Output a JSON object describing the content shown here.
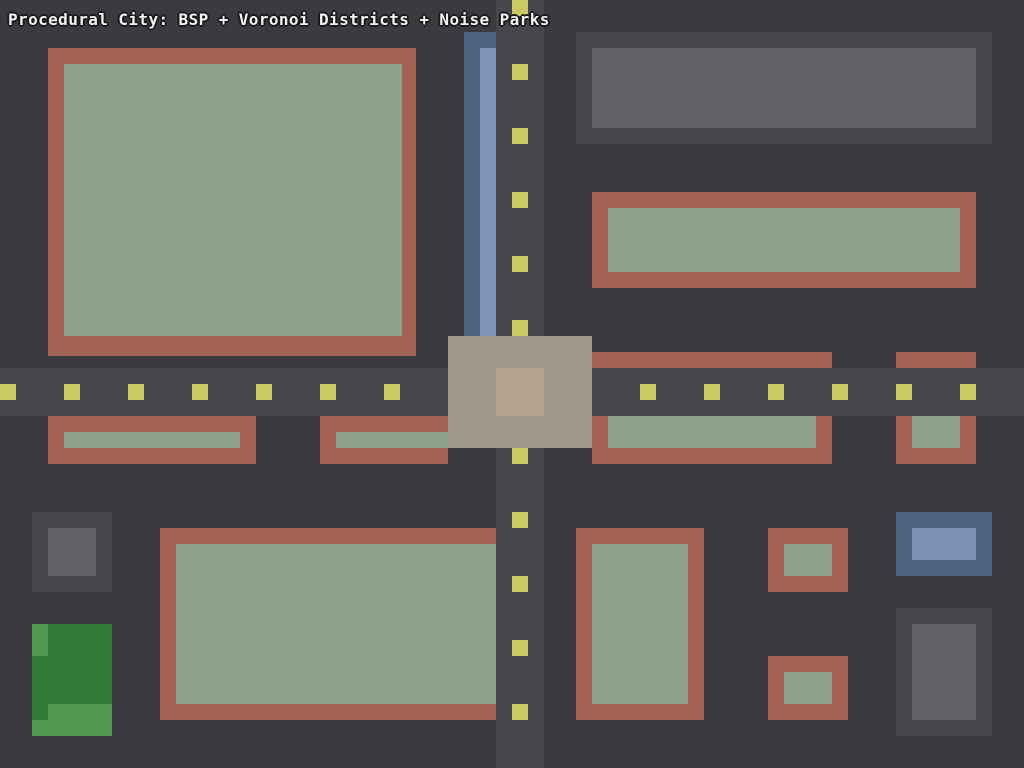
{
  "title": {
    "text": "Procedural City: BSP + Voronoi Districts + Noise Parks"
  },
  "palette": {
    "bg": "#3A3A3F",
    "road": "#46464B",
    "dash": "#C9CB62",
    "wall": "#A26352",
    "roof": "#8DA28B",
    "grayWall": "#46464B",
    "grayRoof": "#636367",
    "plazaOuter": "#A1968A",
    "plazaInner": "#B5A28C",
    "riverDark": "#4F6180",
    "riverLight": "#8093B4",
    "blueWall": "#4F6180",
    "blueRoof": "#7E92B3",
    "parkDark": "#327B36",
    "parkLight": "#529851",
    "titleText": "#F2F2F2"
  },
  "map": {
    "width": 1024,
    "height": 768,
    "rects": [
      {
        "name": "river-segment-dark",
        "x": 464,
        "y": 32,
        "w": 32,
        "h": 304,
        "color": "riverDark"
      },
      {
        "name": "river-segment-light",
        "x": 480,
        "y": 48,
        "w": 16,
        "h": 288,
        "color": "riverLight"
      },
      {
        "name": "building-nw-wall",
        "x": 48,
        "y": 48,
        "w": 368,
        "h": 308,
        "color": "wall"
      },
      {
        "name": "building-nw-roof",
        "x": 64,
        "y": 64,
        "w": 338,
        "h": 272,
        "color": "roof"
      },
      {
        "name": "building-ne-gray-wall",
        "x": 576,
        "y": 32,
        "w": 416,
        "h": 112,
        "color": "grayWall"
      },
      {
        "name": "building-ne-gray-roof",
        "x": 592,
        "y": 48,
        "w": 384,
        "h": 80,
        "color": "grayRoof"
      },
      {
        "name": "building-ne-brown-wall",
        "x": 592,
        "y": 192,
        "w": 384,
        "h": 96,
        "color": "wall"
      },
      {
        "name": "building-ne-brown-roof",
        "x": 608,
        "y": 208,
        "w": 352,
        "h": 64,
        "color": "roof"
      },
      {
        "name": "building-midright-a-wall",
        "x": 592,
        "y": 352,
        "w": 240,
        "h": 112,
        "color": "wall"
      },
      {
        "name": "building-midright-a-roof",
        "x": 608,
        "y": 368,
        "w": 208,
        "h": 80,
        "color": "roof"
      },
      {
        "name": "building-midright-b-wall",
        "x": 896,
        "y": 352,
        "w": 80,
        "h": 112,
        "color": "wall"
      },
      {
        "name": "building-midright-b-roof",
        "x": 912,
        "y": 368,
        "w": 48,
        "h": 80,
        "color": "roof"
      },
      {
        "name": "building-midleft-a-wall",
        "x": 48,
        "y": 416,
        "w": 208,
        "h": 48,
        "color": "wall"
      },
      {
        "name": "building-midleft-a-roof",
        "x": 64,
        "y": 432,
        "w": 176,
        "h": 16,
        "color": "roof"
      },
      {
        "name": "building-midleft-b-wall",
        "x": 320,
        "y": 416,
        "w": 128,
        "h": 48,
        "color": "wall"
      },
      {
        "name": "building-midleft-b-roof",
        "x": 336,
        "y": 432,
        "w": 112,
        "h": 16,
        "color": "roof"
      },
      {
        "name": "road-horizontal",
        "x": 0,
        "y": 368,
        "w": 1024,
        "h": 48,
        "color": "road"
      },
      {
        "name": "road-vertical",
        "x": 496,
        "y": 0,
        "w": 48,
        "h": 768,
        "color": "road"
      },
      {
        "name": "plaza",
        "x": 448,
        "y": 336,
        "w": 144,
        "h": 112,
        "color": "plazaOuter"
      },
      {
        "name": "plaza-center",
        "x": 496,
        "y": 368,
        "w": 48,
        "h": 48,
        "color": "plazaInner"
      },
      {
        "name": "building-sw-gray-wall",
        "x": 32,
        "y": 512,
        "w": 80,
        "h": 80,
        "color": "grayWall"
      },
      {
        "name": "building-sw-gray-roof",
        "x": 48,
        "y": 528,
        "w": 48,
        "h": 48,
        "color": "grayRoof"
      },
      {
        "name": "park",
        "x": 32,
        "y": 624,
        "w": 80,
        "h": 112,
        "color": "parkDark"
      },
      {
        "name": "park-patch-1",
        "x": 32,
        "y": 624,
        "w": 16,
        "h": 32,
        "color": "parkLight"
      },
      {
        "name": "park-patch-2",
        "x": 48,
        "y": 704,
        "w": 64,
        "h": 32,
        "color": "parkLight"
      },
      {
        "name": "park-patch-3",
        "x": 32,
        "y": 720,
        "w": 16,
        "h": 16,
        "color": "parkLight"
      },
      {
        "name": "building-south-a-wall",
        "x": 160,
        "y": 528,
        "w": 336,
        "h": 192,
        "color": "wall"
      },
      {
        "name": "building-south-a-roof",
        "x": 176,
        "y": 544,
        "w": 320,
        "h": 160,
        "color": "roof"
      },
      {
        "name": "building-south-b-wall",
        "x": 576,
        "y": 528,
        "w": 128,
        "h": 192,
        "color": "wall"
      },
      {
        "name": "building-south-b-roof",
        "x": 592,
        "y": 544,
        "w": 96,
        "h": 160,
        "color": "roof"
      },
      {
        "name": "building-south-c-wall",
        "x": 768,
        "y": 528,
        "w": 80,
        "h": 64,
        "color": "wall"
      },
      {
        "name": "building-south-c-roof",
        "x": 784,
        "y": 544,
        "w": 48,
        "h": 32,
        "color": "roof"
      },
      {
        "name": "building-south-d-wall",
        "x": 768,
        "y": 656,
        "w": 80,
        "h": 64,
        "color": "wall"
      },
      {
        "name": "building-south-d-roof",
        "x": 784,
        "y": 672,
        "w": 48,
        "h": 32,
        "color": "roof"
      },
      {
        "name": "building-se-blue-wall",
        "x": 896,
        "y": 512,
        "w": 96,
        "h": 64,
        "color": "blueWall"
      },
      {
        "name": "building-se-blue-roof",
        "x": 912,
        "y": 528,
        "w": 64,
        "h": 32,
        "color": "blueRoof"
      },
      {
        "name": "building-se-gray-wall",
        "x": 896,
        "y": 608,
        "w": 96,
        "h": 128,
        "color": "grayWall"
      },
      {
        "name": "building-se-gray-roof",
        "x": 912,
        "y": 624,
        "w": 64,
        "h": 96,
        "color": "grayRoof"
      }
    ],
    "dashes": {
      "size": 16,
      "color": "dash",
      "z": 185,
      "horizontal": {
        "y": 384,
        "xs": [
          0,
          64,
          128,
          192,
          256,
          320,
          384,
          448,
          512,
          576,
          640,
          704,
          768,
          832,
          896,
          960
        ]
      },
      "vertical": {
        "x": 512,
        "ys": [
          0,
          64,
          128,
          192,
          256,
          320,
          384,
          448,
          512,
          576,
          640,
          704
        ]
      }
    }
  }
}
